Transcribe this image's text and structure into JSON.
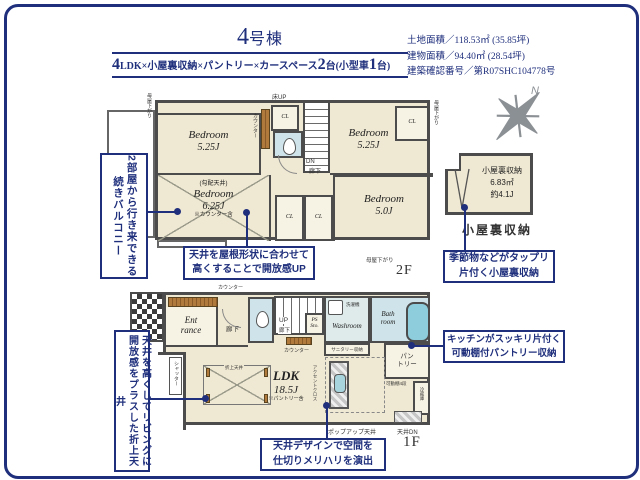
{
  "colors": {
    "navy": "#1f2f7c",
    "wall": "#4c4c4c",
    "room_cream": "#efe8d2",
    "water_blue": "#cfe4ea",
    "tub_blue": "#8ecddc",
    "wood_brown": "#b07a3c",
    "compass_gray": "#8b9095"
  },
  "header": {
    "title_num": "4",
    "title_suffix": "号棟",
    "subtitle": {
      "n1": "4",
      "t1": "LDK×小屋裏収納×パントリー×カースペース",
      "n2": "2",
      "t2": "台(小型車",
      "n3": "1",
      "t3": "台)"
    },
    "info_lines": [
      "土地面積／118.53㎡ (35.85坪)",
      "建物面積／94.40㎡ (28.54坪)",
      "建築確認番号／第R07SHC104778号"
    ]
  },
  "compass": {
    "north": "N"
  },
  "floor2": {
    "label": "2F",
    "moya": "母屋下がり",
    "yuka_up": "床UP",
    "counter": "カウンター",
    "dn": "DN",
    "rouka": "廊下",
    "cl": "CL",
    "balcony": "Balcony",
    "nw": {
      "name": "Bedroom",
      "size": "5.25J"
    },
    "ne": {
      "name": "Bedroom",
      "size": "5.25J"
    },
    "sw": {
      "ceiling": "(勾配天井)",
      "name": "Bedroom",
      "size": "6.25J",
      "note": "※カウンター含"
    },
    "se": {
      "name": "Bedroom",
      "size": "5.0J"
    }
  },
  "attic": {
    "line1": "小屋裏収納",
    "line2": "6.83㎡",
    "line3": "約4.1J",
    "caption": "小屋裏収納"
  },
  "floor1": {
    "label": "1F",
    "counter": "カウンター",
    "ent1": "Ent",
    "ent2": "rance",
    "rouka": "廊下",
    "up": "UP",
    "ps": "PS",
    "sto": "Sto.",
    "washroom": "Washroom",
    "washer": "洗濯機",
    "bath1": "Bath",
    "bath2": "room",
    "sanitary": "サニタリー収納",
    "pantry1": "パン",
    "pantry2": "トリー",
    "shelf": "可動棚4段",
    "ldk": "LDK",
    "ldk_size": "18.5J",
    "ldk_note": "※パントリー含",
    "coffered": "折上天井",
    "shutter": "シャッター",
    "accent": "アクセントクロス",
    "fridge": "冷蔵庫",
    "popup": "ポップアップ天井",
    "ceiling_dn": "天井DN"
  },
  "callouts": {
    "balcony": {
      "l1": "2部屋から行き来できる",
      "l2": "続きバルコニー"
    },
    "ceiling2f": {
      "l1": "天井を屋根形状に合わせて",
      "l2": "高くすることで開放感UP"
    },
    "attic": {
      "l1": "季節物などがタップリ",
      "l2": "片付く小屋裏収納"
    },
    "pantry": {
      "l1": "キッチンがスッキリ片付く",
      "l2": "可動棚付パントリー収納"
    },
    "coffered": {
      "l1": "天井を高くしてリビングに",
      "l2": "開放感をプラスした折上天井"
    },
    "design": {
      "l1": "天井デザインで空間を",
      "l2": "仕切りメリハリを演出"
    }
  }
}
